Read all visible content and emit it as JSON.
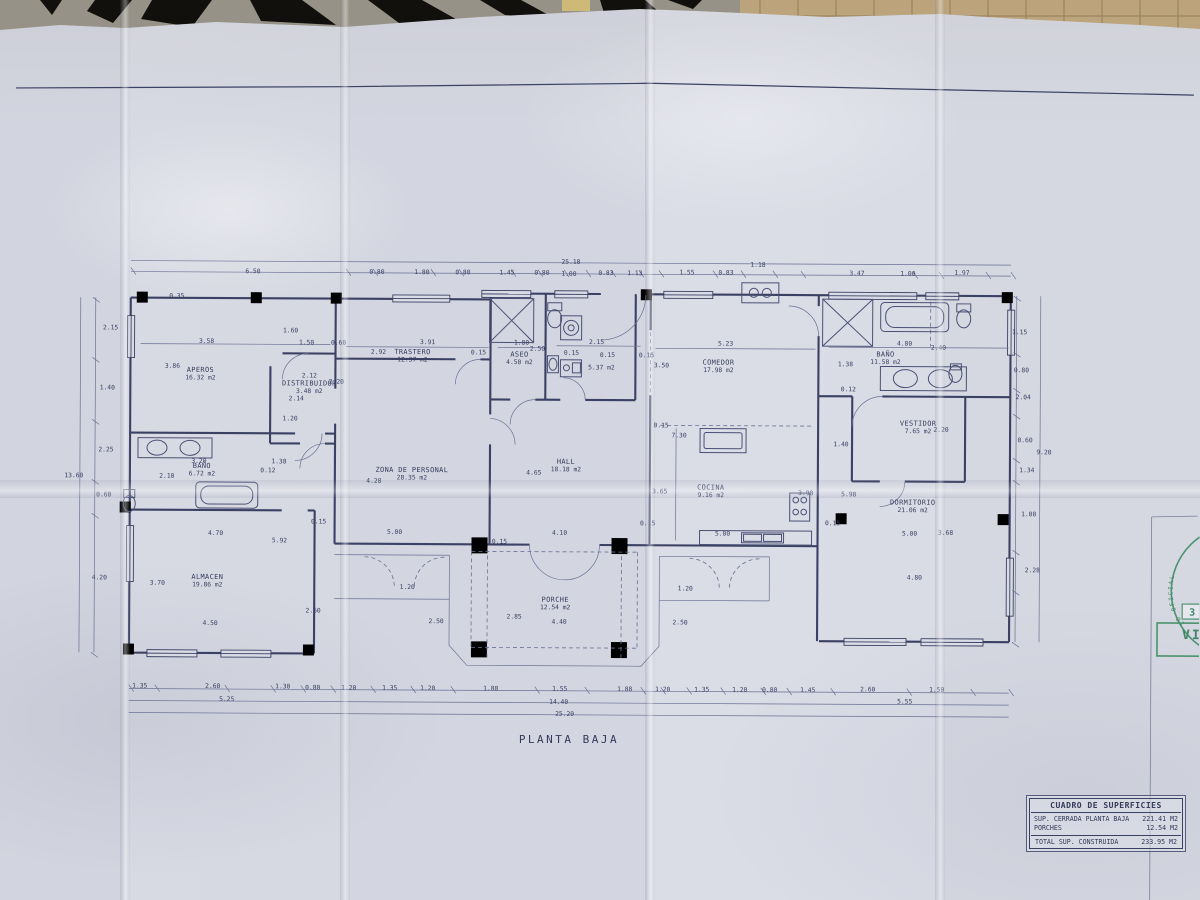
{
  "plan": {
    "title": "PLANTA BAJA",
    "rooms": [
      {
        "name": "APEROS",
        "area": "16.32 m2",
        "x": 200,
        "y": 374
      },
      {
        "name": "DISTRIBUIDOR",
        "area": "3.48 m2",
        "x": 309,
        "y": 387
      },
      {
        "name": "BAÑO",
        "area": "6.72 m2",
        "x": 202,
        "y": 470
      },
      {
        "name": "ALMACEN",
        "area": "19.86 m2",
        "x": 208,
        "y": 581
      },
      {
        "name": "TRASTERO",
        "area": "12.37 m2",
        "x": 412,
        "y": 355
      },
      {
        "name": "ASEO",
        "area": "4.50 m2",
        "x": 519,
        "y": 357
      },
      {
        "name": "",
        "area": "5.37 m2",
        "x": 601,
        "y": 362
      },
      {
        "name": "ZONA DE PERSONAL",
        "area": "28.35 m2",
        "x": 412,
        "y": 473
      },
      {
        "name": "HALL",
        "area": "18.18 m2",
        "x": 566,
        "y": 464
      },
      {
        "name": "COMEDOR",
        "area": "17.98 m2",
        "x": 718,
        "y": 364
      },
      {
        "name": "COCINA",
        "area": "9.16 m2",
        "x": 711,
        "y": 489
      },
      {
        "name": "BAÑO",
        "area": "11.58 m2",
        "x": 885,
        "y": 355
      },
      {
        "name": "VESTIDOR",
        "area": "7.65 m2",
        "x": 918,
        "y": 424
      },
      {
        "name": "DORMITORIO",
        "area": "21.06 m2",
        "x": 913,
        "y": 503
      },
      {
        "name": "PORCHE",
        "area": "12.54 m2",
        "x": 556,
        "y": 602
      }
    ],
    "dims": [
      {
        "t": "25.18",
        "x": 570,
        "y": 264
      },
      {
        "t": "6.50",
        "x": 252,
        "y": 275
      },
      {
        "t": "0.80",
        "x": 376,
        "y": 275
      },
      {
        "t": "1.80",
        "x": 421,
        "y": 275
      },
      {
        "t": "0.80",
        "x": 462,
        "y": 275
      },
      {
        "t": "1.45",
        "x": 506,
        "y": 275
      },
      {
        "t": "0.80",
        "x": 541,
        "y": 275
      },
      {
        "t": "1.00",
        "x": 568,
        "y": 276
      },
      {
        "t": "0.83",
        "x": 605,
        "y": 275
      },
      {
        "t": "1.13",
        "x": 634,
        "y": 275
      },
      {
        "t": "1.55",
        "x": 686,
        "y": 274
      },
      {
        "t": "0.83",
        "x": 725,
        "y": 274
      },
      {
        "t": "1.18",
        "x": 757,
        "y": 266
      },
      {
        "t": "3.47",
        "x": 856,
        "y": 274
      },
      {
        "t": "1.00",
        "x": 907,
        "y": 274
      },
      {
        "t": "1.97",
        "x": 961,
        "y": 273
      },
      {
        "t": "2.15",
        "x": 110,
        "y": 332
      },
      {
        "t": "1.40",
        "x": 107,
        "y": 392
      },
      {
        "t": "2.25",
        "x": 106,
        "y": 454
      },
      {
        "t": "0.60",
        "x": 104,
        "y": 499
      },
      {
        "t": "4.20",
        "x": 100,
        "y": 582
      },
      {
        "t": "13.60",
        "x": 74,
        "y": 480
      },
      {
        "t": "1.15",
        "x": 1019,
        "y": 332
      },
      {
        "t": "0.80",
        "x": 1021,
        "y": 370
      },
      {
        "t": "2.04",
        "x": 1023,
        "y": 397
      },
      {
        "t": "0.60",
        "x": 1025,
        "y": 440
      },
      {
        "t": "9.20",
        "x": 1044,
        "y": 452
      },
      {
        "t": "1.34",
        "x": 1027,
        "y": 470
      },
      {
        "t": "1.00",
        "x": 1029,
        "y": 514
      },
      {
        "t": "2.28",
        "x": 1033,
        "y": 570
      },
      {
        "t": "1.35",
        "x": 141,
        "y": 690
      },
      {
        "t": "2.60",
        "x": 214,
        "y": 690
      },
      {
        "t": "1.30",
        "x": 284,
        "y": 690
      },
      {
        "t": "0.80",
        "x": 314,
        "y": 691
      },
      {
        "t": "1.20",
        "x": 350,
        "y": 691
      },
      {
        "t": "1.35",
        "x": 391,
        "y": 691
      },
      {
        "t": "1.20",
        "x": 429,
        "y": 691
      },
      {
        "t": "1.88",
        "x": 492,
        "y": 691
      },
      {
        "t": "1.55",
        "x": 561,
        "y": 691
      },
      {
        "t": "1.88",
        "x": 626,
        "y": 691
      },
      {
        "t": "1.20",
        "x": 664,
        "y": 691
      },
      {
        "t": "1.35",
        "x": 703,
        "y": 691
      },
      {
        "t": "1.20",
        "x": 741,
        "y": 691
      },
      {
        "t": "0.80",
        "x": 771,
        "y": 691
      },
      {
        "t": "1.45",
        "x": 809,
        "y": 691
      },
      {
        "t": "2.60",
        "x": 869,
        "y": 690
      },
      {
        "t": "1.50",
        "x": 938,
        "y": 690
      },
      {
        "t": "5.25",
        "x": 228,
        "y": 703
      },
      {
        "t": "14.40",
        "x": 560,
        "y": 704
      },
      {
        "t": "5.55",
        "x": 906,
        "y": 702
      },
      {
        "t": "25.20",
        "x": 566,
        "y": 716
      },
      {
        "t": "0.35",
        "x": 176,
        "y": 300
      },
      {
        "t": "3.58",
        "x": 206,
        "y": 345
      },
      {
        "t": "3.86",
        "x": 172,
        "y": 370
      },
      {
        "t": "1.60",
        "x": 290,
        "y": 334
      },
      {
        "t": "1.50",
        "x": 306,
        "y": 346
      },
      {
        "t": "0.60",
        "x": 338,
        "y": 346
      },
      {
        "t": "2.12",
        "x": 309,
        "y": 379
      },
      {
        "t": "2.20",
        "x": 336,
        "y": 385
      },
      {
        "t": "2.14",
        "x": 296,
        "y": 402
      },
      {
        "t": "1.20",
        "x": 290,
        "y": 422
      },
      {
        "t": "3.20",
        "x": 199,
        "y": 465
      },
      {
        "t": "1.38",
        "x": 279,
        "y": 465
      },
      {
        "t": "0.12",
        "x": 268,
        "y": 474
      },
      {
        "t": "2.10",
        "x": 167,
        "y": 480
      },
      {
        "t": "0.15",
        "x": 319,
        "y": 525
      },
      {
        "t": "4.70",
        "x": 216,
        "y": 537
      },
      {
        "t": "5.92",
        "x": 280,
        "y": 544
      },
      {
        "t": "3.70",
        "x": 158,
        "y": 587
      },
      {
        "t": "4.50",
        "x": 211,
        "y": 627
      },
      {
        "t": "2.60",
        "x": 314,
        "y": 614
      },
      {
        "t": "2.92",
        "x": 378,
        "y": 355
      },
      {
        "t": "3.91",
        "x": 427,
        "y": 345
      },
      {
        "t": "0.15",
        "x": 478,
        "y": 355
      },
      {
        "t": "1.80",
        "x": 521,
        "y": 345
      },
      {
        "t": "2.50",
        "x": 537,
        "y": 351
      },
      {
        "t": "0.15",
        "x": 571,
        "y": 355
      },
      {
        "t": "2.15",
        "x": 596,
        "y": 344
      },
      {
        "t": "0.15",
        "x": 607,
        "y": 357
      },
      {
        "t": "0.15",
        "x": 646,
        "y": 357
      },
      {
        "t": "3.50",
        "x": 661,
        "y": 367
      },
      {
        "t": "5.23",
        "x": 725,
        "y": 345
      },
      {
        "t": "4.28",
        "x": 374,
        "y": 484
      },
      {
        "t": "5.00",
        "x": 395,
        "y": 535
      },
      {
        "t": "4.65",
        "x": 534,
        "y": 475
      },
      {
        "t": "0.15",
        "x": 500,
        "y": 544
      },
      {
        "t": "4.10",
        "x": 560,
        "y": 535
      },
      {
        "t": "0.15",
        "x": 648,
        "y": 525
      },
      {
        "t": "0.15",
        "x": 661,
        "y": 427
      },
      {
        "t": "7.30",
        "x": 679,
        "y": 437
      },
      {
        "t": "3.65",
        "x": 660,
        "y": 493
      },
      {
        "t": "5.00",
        "x": 723,
        "y": 535
      },
      {
        "t": "3.90",
        "x": 806,
        "y": 494
      },
      {
        "t": "1.38",
        "x": 845,
        "y": 365
      },
      {
        "t": "0.12",
        "x": 848,
        "y": 390
      },
      {
        "t": "4.80",
        "x": 904,
        "y": 344
      },
      {
        "t": "2.40",
        "x": 938,
        "y": 348
      },
      {
        "t": "2.20",
        "x": 941,
        "y": 430
      },
      {
        "t": "1.40",
        "x": 841,
        "y": 445
      },
      {
        "t": "0.15",
        "x": 833,
        "y": 524
      },
      {
        "t": "5.98",
        "x": 849,
        "y": 495
      },
      {
        "t": "5.00",
        "x": 910,
        "y": 534
      },
      {
        "t": "3.68",
        "x": 946,
        "y": 533
      },
      {
        "t": "4.80",
        "x": 915,
        "y": 578
      },
      {
        "t": "1.20",
        "x": 408,
        "y": 590
      },
      {
        "t": "2.50",
        "x": 437,
        "y": 624
      },
      {
        "t": "2.85",
        "x": 515,
        "y": 619
      },
      {
        "t": "4.40",
        "x": 560,
        "y": 624
      },
      {
        "t": "1.20",
        "x": 686,
        "y": 590
      },
      {
        "t": "2.50",
        "x": 681,
        "y": 624
      }
    ]
  },
  "summary_table": {
    "title": "CUADRO DE SUPERFICIES",
    "rows": [
      {
        "label": "SUP. CERRADA PLANTA BAJA",
        "value": "221.41 M2"
      },
      {
        "label": "PORCHES",
        "value": "12.54 M2"
      },
      {
        "label": "TOTAL SUP. CONSTRUIDA",
        "value": "233.95 M2"
      }
    ]
  },
  "stamp": {
    "arc_text": "IO OFICIAL",
    "box_number": "3",
    "letters": "VI",
    "color": "#3a8a5f"
  }
}
